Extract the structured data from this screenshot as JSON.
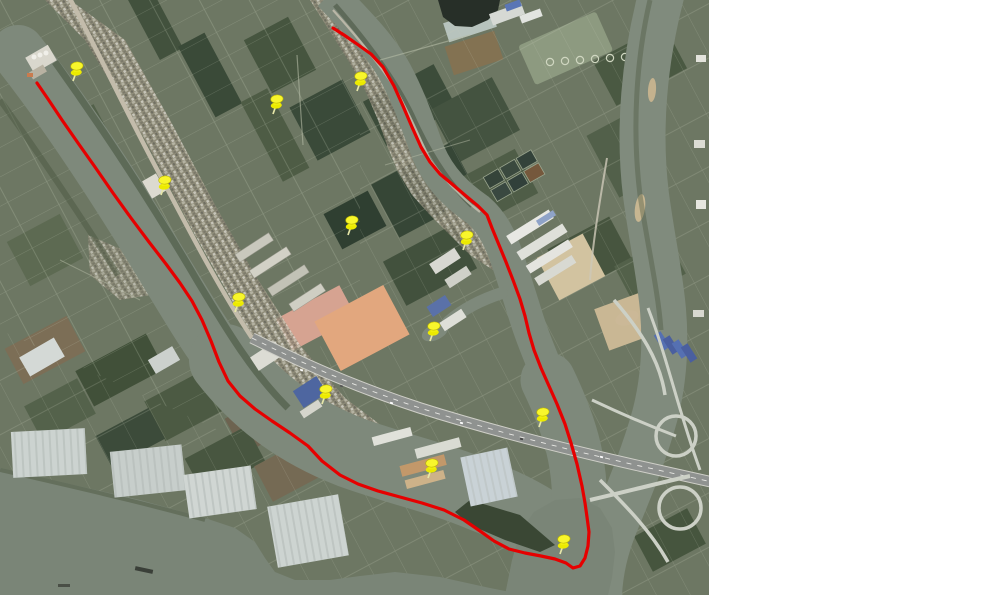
{
  "page": {
    "background": "#ffffff"
  },
  "map": {
    "kind": "satellite-imagery-with-annotations",
    "area": {
      "x": 0,
      "y": 0,
      "width": 709,
      "height": 595
    },
    "palette": {
      "water": "#7e897b",
      "water_dark": "#7a8577",
      "land": "#6d7763",
      "route_red": "#e60000",
      "pin_yellow": "#f6f41e",
      "pin_cap": "#f8f62c",
      "pin_outline": "#b9b400",
      "pin_needle": "#e6e6a8",
      "road_light": "#c3bcab",
      "highway_gray": "#8f9290"
    },
    "route": {
      "name": "red-survey-boundary",
      "stroke_width": 3.2,
      "path_d": "M37 83L48 99L62 120L78 143L95 167L113 193L131 218L149 242L166 264L180 283L192 301L202 320L211 341L219 362L228 381L240 396L255 409L272 421L290 433L308 446L322 461L340 475L358 484L378 491L400 497L422 503L444 510L464 520L480 531L494 541L509 549L525 553L541 556L555 559L566 563L573 568L580 566L585 558L588 546L589 532L587 517L585 503L582 486L577 464L571 443L565 424L557 404L549 386L541 368L534 350L529 333L525 316L520 299L513 280L506 262L499 245L492 228L487 215L478 206L466 196L452 184L440 174L430 162L421 147L412 127L403 106L394 86L383 67L371 54L357 44L344 35L333 28"
    },
    "pins": [
      {
        "id": "pin-1",
        "x": 73,
        "y": 81
      },
      {
        "id": "pin-2",
        "x": 273,
        "y": 114
      },
      {
        "id": "pin-3",
        "x": 357,
        "y": 91
      },
      {
        "id": "pin-4",
        "x": 161,
        "y": 195
      },
      {
        "id": "pin-5",
        "x": 348,
        "y": 235
      },
      {
        "id": "pin-6",
        "x": 463,
        "y": 250
      },
      {
        "id": "pin-7",
        "x": 235,
        "y": 312
      },
      {
        "id": "pin-8",
        "x": 430,
        "y": 341
      },
      {
        "id": "pin-9",
        "x": 322,
        "y": 404
      },
      {
        "id": "pin-10",
        "x": 428,
        "y": 478
      },
      {
        "id": "pin-11",
        "x": 539,
        "y": 427
      },
      {
        "id": "pin-12",
        "x": 560,
        "y": 554
      }
    ]
  }
}
